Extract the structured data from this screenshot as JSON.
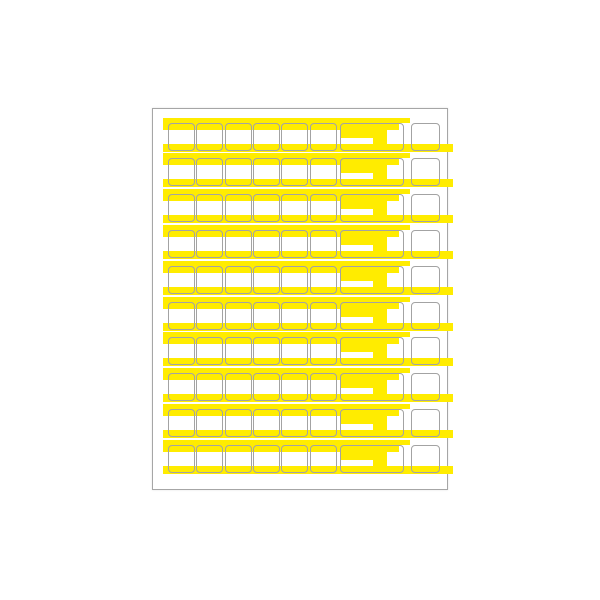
{
  "sheet": {
    "kind": "blank-label-template-sheet",
    "row_count": 10,
    "row_structure": {
      "small_cells_per_row": 6,
      "wide_cells_per_row": 1,
      "end_cells_per_row": 1
    },
    "highlights_per_row": {
      "top_band": 1,
      "top_band_tail": 1,
      "wide_cell_block": 1,
      "wide_cell_step": 1,
      "bottom_band": 1
    },
    "colors": {
      "highlight_yellow": "#ffec00",
      "cell_border": "#a3a3a3",
      "page_border": "#a6a6a6",
      "background": "#ffffff"
    }
  }
}
